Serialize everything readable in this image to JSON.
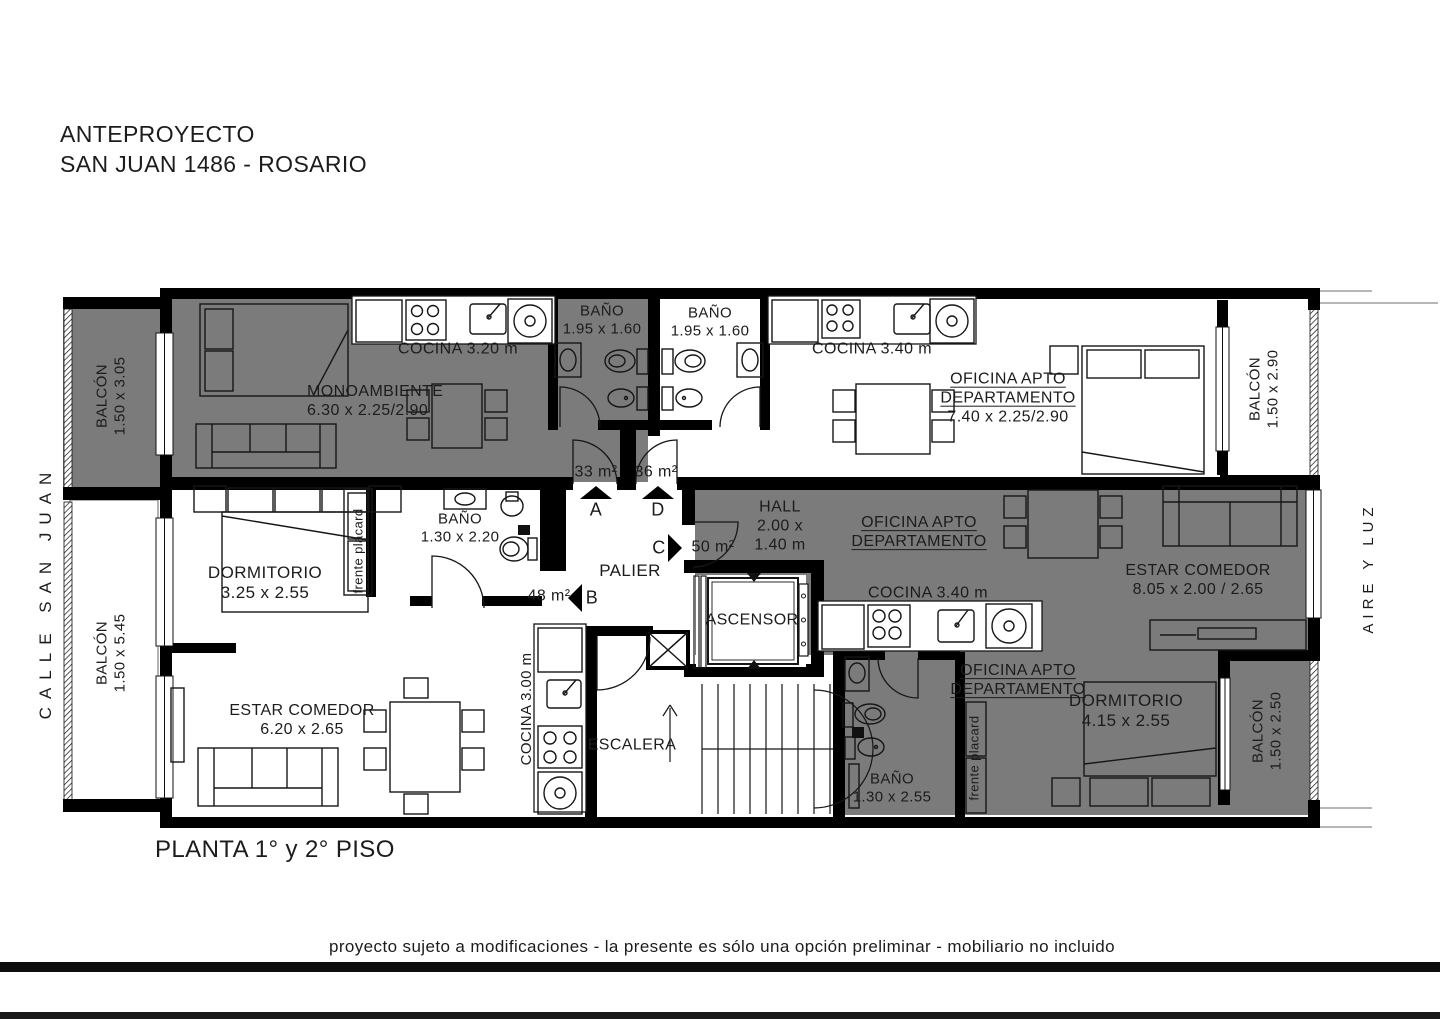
{
  "colors": {
    "unit_gray": "#7b7b7b",
    "wall": "#000000",
    "text": "#1c1c1c"
  },
  "title": {
    "line1": "ANTEPROYECTO",
    "line2": "SAN JUAN 1486 - ROSARIO"
  },
  "context": {
    "street_left": "CALLE SAN JUAN",
    "street_right": "AIRE Y LUZ"
  },
  "balconies": {
    "left_top": {
      "name": "BALCÓN",
      "dim": "1.50 x 3.05"
    },
    "left_bottom": {
      "name": "BALCÓN",
      "dim": "1.50 x 5.45"
    },
    "right_top": {
      "name": "BALCÓN",
      "dim": "1.50 x 2.90"
    },
    "right_bottom": {
      "name": "BALCÓN",
      "dim": "1.50 x 2.50"
    }
  },
  "units": {
    "a": {
      "letter": "A",
      "area": "33 m²"
    },
    "b": {
      "letter": "B",
      "area": "48 m²"
    },
    "c": {
      "letter": "C",
      "area": "50 m²"
    },
    "d": {
      "letter": "D",
      "area": "36 m²"
    }
  },
  "rooms": {
    "monoambiente": {
      "name": "MONOAMBIENTE",
      "dim": "6.30 x 2.25/2.90"
    },
    "cocina_a": "COCINA 3.20 m",
    "bano_a": {
      "name": "BAÑO",
      "dim": "1.95 x 1.60"
    },
    "bano_d": {
      "name": "BAÑO",
      "dim": "1.95 x 1.60"
    },
    "cocina_d": "COCINA 3.40 m",
    "oficina_d": {
      "line1": "OFICINA APTO",
      "line2": "DEPARTAMENTO",
      "dim": "7.40 x 2.25/2.90"
    },
    "hall": {
      "name": "HALL",
      "dim1": "2.00 x",
      "dim2": "1.40 m"
    },
    "oficina_c": {
      "line1": "OFICINA APTO",
      "line2": "DEPARTAMENTO"
    },
    "cocina_c": "COCINA 3.40 m",
    "estar_c": {
      "name": "ESTAR COMEDOR",
      "dim": "8.05 x 2.00 / 2.65"
    },
    "oficina_c2": {
      "line1": "OFICINA APTO",
      "line2": "DEPARTAMENTO"
    },
    "dormitorio_c": {
      "name": "DORMITORIO",
      "dim": "4.15 x 2.55"
    },
    "bano_c": {
      "name": "BAÑO",
      "dim": "1.30 x 2.55"
    },
    "placard_c": "frente placard",
    "dormitorio_b": {
      "name": "DORMITORIO",
      "dim": "3.25 x 2.55"
    },
    "bano_b": {
      "name": "BAÑO",
      "dim": "1.30 x 2.20"
    },
    "placard_b": "frente placard",
    "estar_b": {
      "name": "ESTAR COMEDOR",
      "dim": "6.20 x 2.65"
    },
    "cocina_b": "COCINA 3.00 m",
    "palier": "PALIER",
    "ascensor": "ASCENSOR",
    "escalera": "ESCALERA"
  },
  "footer": {
    "plan": "PLANTA 1° y 2° PISO",
    "disclaimer": "proyecto sujeto a modificaciones - la presente es sólo una opción preliminar - mobiliario no incluido"
  }
}
